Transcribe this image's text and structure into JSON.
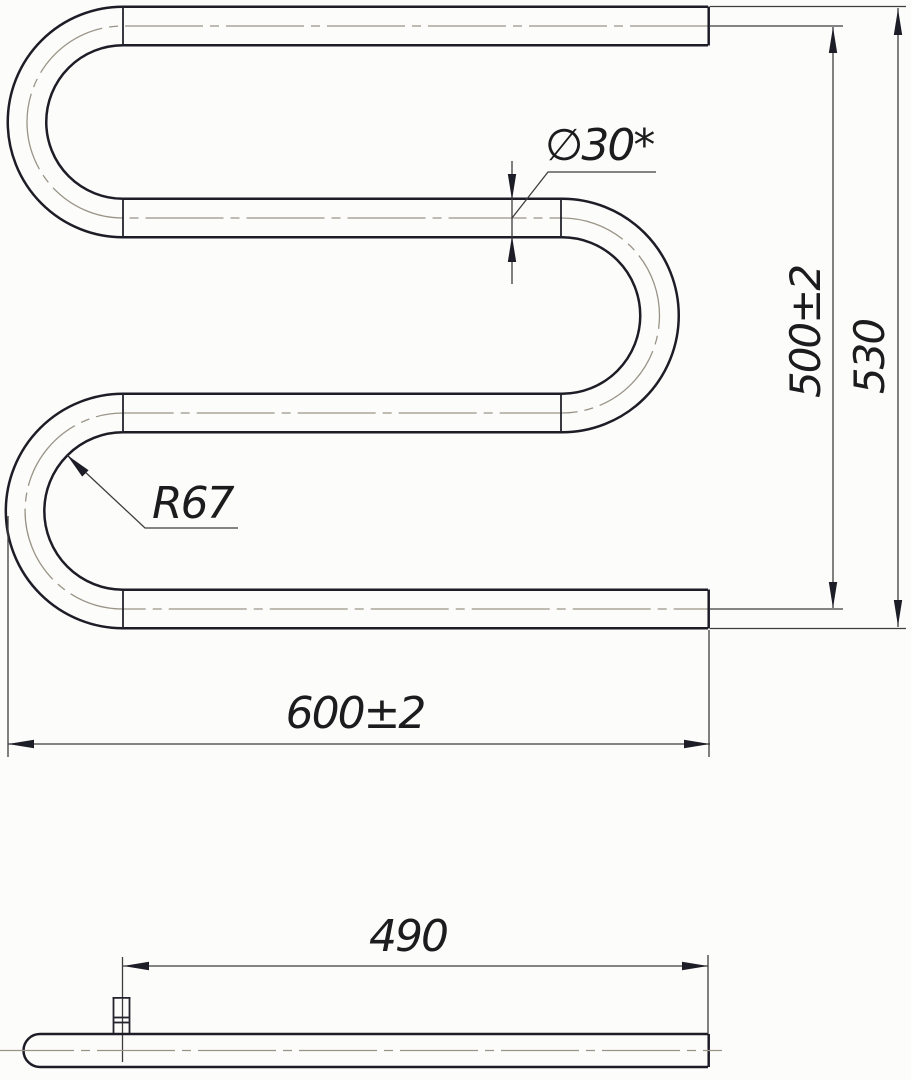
{
  "drawing": {
    "type": "technical-drawing",
    "views": {
      "front_view": "serpentine-pipe-towel-rail",
      "bottom_view": "pipe-with-mounting-fitting"
    },
    "labels": {
      "diameter": "∅30*",
      "height_inner": "500±2",
      "height_overall": "530",
      "bend_radius": "R67",
      "width_overall": "600±2",
      "mount_offset": "490"
    },
    "colors": {
      "background": "#fcfcfa",
      "outline": "#1d1d27",
      "dimension_line": "#3d3d3f",
      "centerline": "#9a9488",
      "text": "#1c1c1e"
    }
  }
}
